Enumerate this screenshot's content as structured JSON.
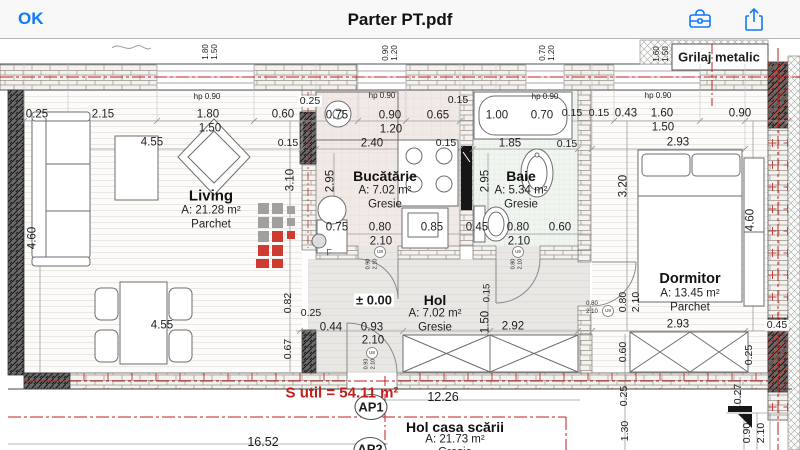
{
  "header": {
    "ok": "OK",
    "title": "Parter PT.pdf"
  },
  "colors": {
    "accent": "#1079fd",
    "annotation": "#c2201a",
    "bar": "#f8f8f8",
    "paper": "#ffffff"
  },
  "plan": {
    "rooms": [
      {
        "slug": "living",
        "name": "Living",
        "area": "A: 21.28 m²",
        "floor": "Parchet",
        "x": 211,
        "y": 196,
        "ns": 15,
        "lh": 14.5
      },
      {
        "slug": "bucatarie",
        "name": "Bucătărie",
        "area": "A: 7.02 m²",
        "floor": "Gresie",
        "x": 385,
        "y": 176,
        "ns": 14,
        "lh": 14.5
      },
      {
        "slug": "baie",
        "name": "Baie",
        "area": "A: 5.34 m²",
        "floor": "Gresie",
        "x": 521,
        "y": 176,
        "ns": 14,
        "lh": 14.5
      },
      {
        "slug": "dormitor",
        "name": "Dormitor",
        "area": "A: 13.45 m²",
        "floor": "Parchet",
        "x": 690,
        "y": 279,
        "ns": 14.5,
        "lh": 14.5
      },
      {
        "slug": "hol",
        "name": "Hol",
        "area": "A: 7.02 m²",
        "floor": "Gresie",
        "x": 435,
        "y": 300,
        "ns": 14,
        "lh": 14
      },
      {
        "slug": "hol-casa-scarii",
        "name": "Hol casa scării",
        "area": "A: 21.73 m²",
        "floor": "Gresie",
        "x": 455,
        "y": 427,
        "ns": 14,
        "lh": 13
      }
    ],
    "labels": [
      {
        "t": "1.80",
        "x": 206,
        "y": 52,
        "s": 8,
        "r": -90
      },
      {
        "t": "1.50",
        "x": 215,
        "y": 52,
        "s": 8,
        "r": -90
      },
      {
        "t": "0.90",
        "x": 386,
        "y": 53,
        "s": 8,
        "r": -90
      },
      {
        "t": "1.20",
        "x": 395,
        "y": 53,
        "s": 8,
        "r": -90
      },
      {
        "t": "0.70",
        "x": 543,
        "y": 53,
        "s": 8,
        "r": -90
      },
      {
        "t": "1.20",
        "x": 552,
        "y": 53,
        "s": 8,
        "r": -90
      },
      {
        "t": "1.60",
        "x": 657,
        "y": 54,
        "s": 8,
        "r": -90
      },
      {
        "t": "1.50",
        "x": 666,
        "y": 54,
        "s": 8,
        "r": -90
      },
      {
        "t": "Grilaj metalic",
        "x": 719,
        "y": 57,
        "s": 13,
        "w": 700,
        "n": "grilaj-metalic-label"
      },
      {
        "t": "hp 0.90",
        "x": 207,
        "y": 97,
        "s": 8
      },
      {
        "t": "hp 0.90",
        "x": 382,
        "y": 96,
        "s": 8
      },
      {
        "t": "hp 0.90",
        "x": 545,
        "y": 97,
        "s": 8
      },
      {
        "t": "hp 0.90",
        "x": 658,
        "y": 96,
        "s": 8
      },
      {
        "t": "0.25",
        "x": 37,
        "y": 115
      },
      {
        "t": "2.15",
        "x": 103,
        "y": 115
      },
      {
        "t": "1.80",
        "x": 208,
        "y": 115
      },
      {
        "t": "1.50",
        "x": 210,
        "y": 129
      },
      {
        "t": "0.60",
        "x": 283,
        "y": 115
      },
      {
        "t": "0.25",
        "x": 310,
        "y": 101,
        "s": 10.5,
        "bg": "#ffffff"
      },
      {
        "t": "0.75",
        "x": 337,
        "y": 116
      },
      {
        "t": "0.90",
        "x": 390,
        "y": 116
      },
      {
        "t": "1.20",
        "x": 391,
        "y": 130
      },
      {
        "t": "0.65",
        "x": 438,
        "y": 116
      },
      {
        "t": "0.15",
        "x": 458,
        "y": 100,
        "s": 10.5
      },
      {
        "t": "1.00",
        "x": 497,
        "y": 116
      },
      {
        "t": "0.70",
        "x": 542,
        "y": 116
      },
      {
        "t": "0.15",
        "x": 572,
        "y": 113,
        "s": 10.5
      },
      {
        "t": "0.15",
        "x": 599,
        "y": 113,
        "s": 10.5
      },
      {
        "t": "0.43",
        "x": 626,
        "y": 114
      },
      {
        "t": "1.60",
        "x": 662,
        "y": 114
      },
      {
        "t": "1.50",
        "x": 663,
        "y": 128
      },
      {
        "t": "0.90",
        "x": 740,
        "y": 114
      },
      {
        "t": "4.55",
        "x": 152,
        "y": 143
      },
      {
        "t": "0.15",
        "x": 288,
        "y": 143,
        "s": 10.5
      },
      {
        "t": "2.40",
        "x": 372,
        "y": 144
      },
      {
        "t": "0.15",
        "x": 446,
        "y": 143,
        "s": 10.5
      },
      {
        "t": "1.85",
        "x": 510,
        "y": 144
      },
      {
        "t": "0.15",
        "x": 567,
        "y": 144,
        "s": 10.5
      },
      {
        "t": "2.93",
        "x": 678,
        "y": 143
      },
      {
        "t": "4.60",
        "x": 33,
        "y": 238,
        "r": -90
      },
      {
        "t": "3.10",
        "x": 291,
        "y": 180,
        "r": -90
      },
      {
        "t": "2.95",
        "x": 331,
        "y": 181,
        "r": -90
      },
      {
        "t": "2.95",
        "x": 486,
        "y": 181,
        "r": -90
      },
      {
        "t": "3.20",
        "x": 624,
        "y": 186,
        "r": -90
      },
      {
        "t": "4.60",
        "x": 751,
        "y": 220,
        "r": -90
      },
      {
        "t": "0.75",
        "x": 337,
        "y": 228
      },
      {
        "t": "0.80",
        "x": 380,
        "y": 228
      },
      {
        "t": "2.10",
        "x": 381,
        "y": 242
      },
      {
        "t": "0.85",
        "x": 432,
        "y": 228
      },
      {
        "t": "0.45",
        "x": 477,
        "y": 228
      },
      {
        "t": "0.80",
        "x": 518,
        "y": 228
      },
      {
        "t": "2.10",
        "x": 519,
        "y": 242
      },
      {
        "t": "0.60",
        "x": 560,
        "y": 228
      },
      {
        "t": "± 0.00",
        "x": 374,
        "y": 300,
        "s": 13,
        "w": 600,
        "bg": "#ffffff",
        "n": "level-marker"
      },
      {
        "t": "0.82",
        "x": 288,
        "y": 303,
        "s": 10.5,
        "r": -90
      },
      {
        "t": "0.67",
        "x": 288,
        "y": 349,
        "s": 10.5,
        "r": -90
      },
      {
        "t": "0.25",
        "x": 311,
        "y": 313,
        "s": 10.5
      },
      {
        "t": "0.44",
        "x": 331,
        "y": 328
      },
      {
        "t": "0.93",
        "x": 372,
        "y": 328
      },
      {
        "t": "2.10",
        "x": 373,
        "y": 341
      },
      {
        "t": "0.15",
        "x": 487,
        "y": 293,
        "s": 9.5,
        "r": -90
      },
      {
        "t": "1.50",
        "x": 486,
        "y": 322,
        "r": -90
      },
      {
        "t": "2.92",
        "x": 513,
        "y": 327
      },
      {
        "t": "4.55",
        "x": 162,
        "y": 326
      },
      {
        "t": "0.80",
        "x": 623,
        "y": 302,
        "s": 10.5,
        "r": -90
      },
      {
        "t": "2.10",
        "x": 636,
        "y": 302,
        "s": 10.5,
        "r": -90
      },
      {
        "t": "2.93",
        "x": 678,
        "y": 325
      },
      {
        "t": "0.45",
        "x": 777,
        "y": 325,
        "s": 10.5,
        "bg": "#ffffff"
      },
      {
        "t": "0.60",
        "x": 623,
        "y": 352,
        "s": 10.5,
        "r": -90
      },
      {
        "t": "0.25",
        "x": 749,
        "y": 355,
        "s": 10.5,
        "r": -90
      },
      {
        "t": "0.27",
        "x": 738,
        "y": 394,
        "s": 10.5,
        "r": -90
      },
      {
        "t": "0.25",
        "x": 624,
        "y": 396,
        "s": 10.5,
        "r": -90
      },
      {
        "t": "1.30",
        "x": 625,
        "y": 431,
        "s": 10.5,
        "r": -90
      },
      {
        "t": "0.90",
        "x": 747,
        "y": 433,
        "s": 10.5,
        "r": -90
      },
      {
        "t": "2.10",
        "x": 761,
        "y": 433,
        "s": 10.5,
        "r": -90
      },
      {
        "t": "12.26",
        "x": 443,
        "y": 397,
        "s": 12.5
      },
      {
        "t": "16.52",
        "x": 263,
        "y": 442,
        "s": 12.5
      },
      {
        "t": "S util = 54.11 m²",
        "x": 342,
        "y": 393,
        "s": 15,
        "w": 700,
        "c": "#c2201a",
        "n": "s-util-label"
      },
      {
        "t": "AP1",
        "x": 371,
        "y": 407,
        "s": 13,
        "w": 700,
        "n": "ap1-label"
      },
      {
        "t": "AP2",
        "x": 370,
        "y": 449,
        "s": 13,
        "w": 700,
        "n": "ap2-label"
      },
      {
        "t": "F",
        "x": 329,
        "y": 253,
        "s": 9,
        "c": "#555555"
      },
      {
        "t": "U8",
        "x": 380,
        "y": 252,
        "s": 4.5
      },
      {
        "t": "U9",
        "x": 518,
        "y": 252,
        "s": 4.5
      },
      {
        "t": "U8",
        "x": 372,
        "y": 353,
        "s": 4.5
      },
      {
        "t": "U9",
        "x": 608,
        "y": 311,
        "s": 4.5
      },
      {
        "t": "0.80",
        "x": 592,
        "y": 304,
        "s": 6
      },
      {
        "t": "2.10",
        "x": 592,
        "y": 312,
        "s": 6
      },
      {
        "t": "0.90",
        "x": 369,
        "y": 264,
        "s": 5.5,
        "r": -90
      },
      {
        "t": "2.10",
        "x": 376,
        "y": 264,
        "s": 5.5,
        "r": -90
      },
      {
        "t": "0.80",
        "x": 514,
        "y": 264,
        "s": 5.5,
        "r": -90
      },
      {
        "t": "2.10",
        "x": 521,
        "y": 264,
        "s": 5.5,
        "r": -90
      },
      {
        "t": "0.93",
        "x": 367,
        "y": 364,
        "s": 5.5,
        "r": -90
      },
      {
        "t": "2.10",
        "x": 374,
        "y": 364,
        "s": 5.5,
        "r": -90
      }
    ]
  }
}
